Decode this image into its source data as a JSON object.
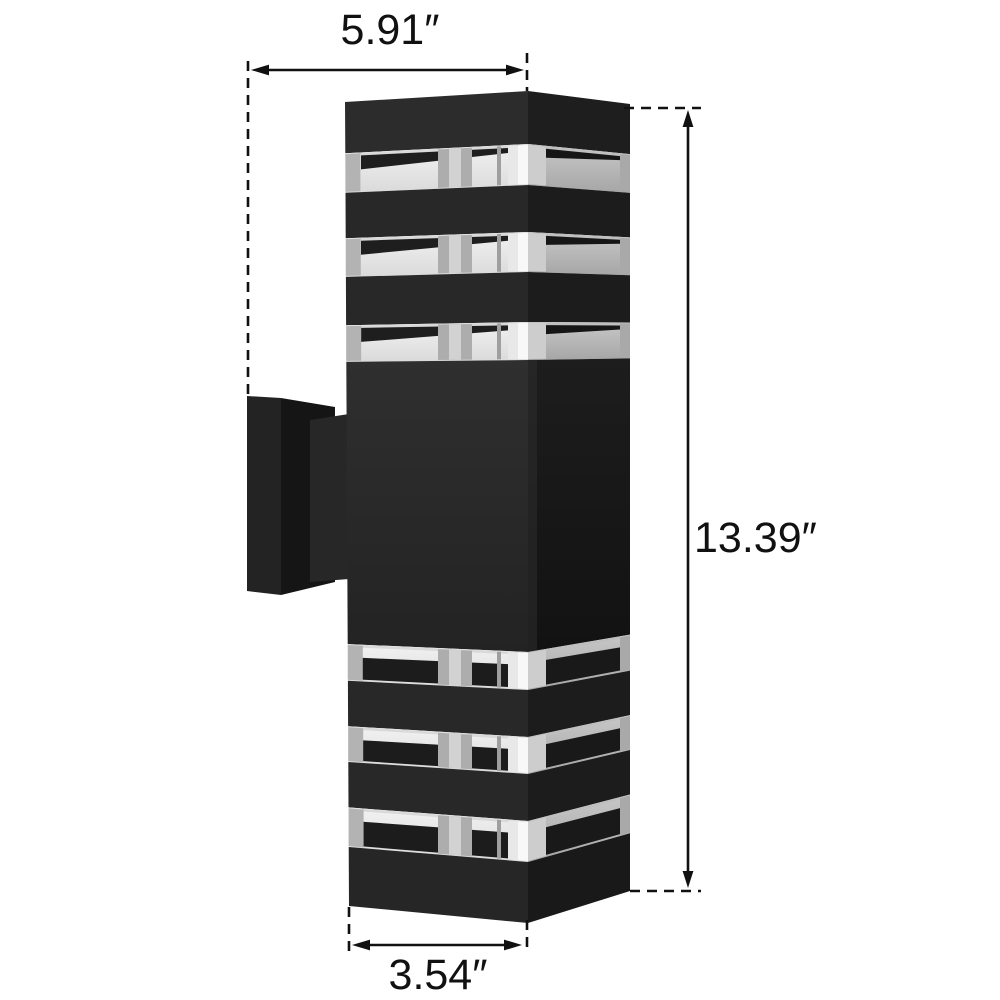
{
  "figure": {
    "kind": "product-dimension-diagram",
    "subject": "black rectangular up-down outdoor wall sconce with clear louver glass bands on a wall-mount bracket"
  },
  "dimensions": {
    "width_label": "5.91″",
    "height_label": "13.39″",
    "depth_label": "3.54″"
  },
  "style": {
    "background": "#ffffff",
    "annotation_color": "#111111",
    "lamp_front": "#282828",
    "lamp_side": "#1c1c1c",
    "glass_front": "#e9e9e9",
    "glass_side": "#b5b5b5",
    "bracket": "#232323"
  }
}
